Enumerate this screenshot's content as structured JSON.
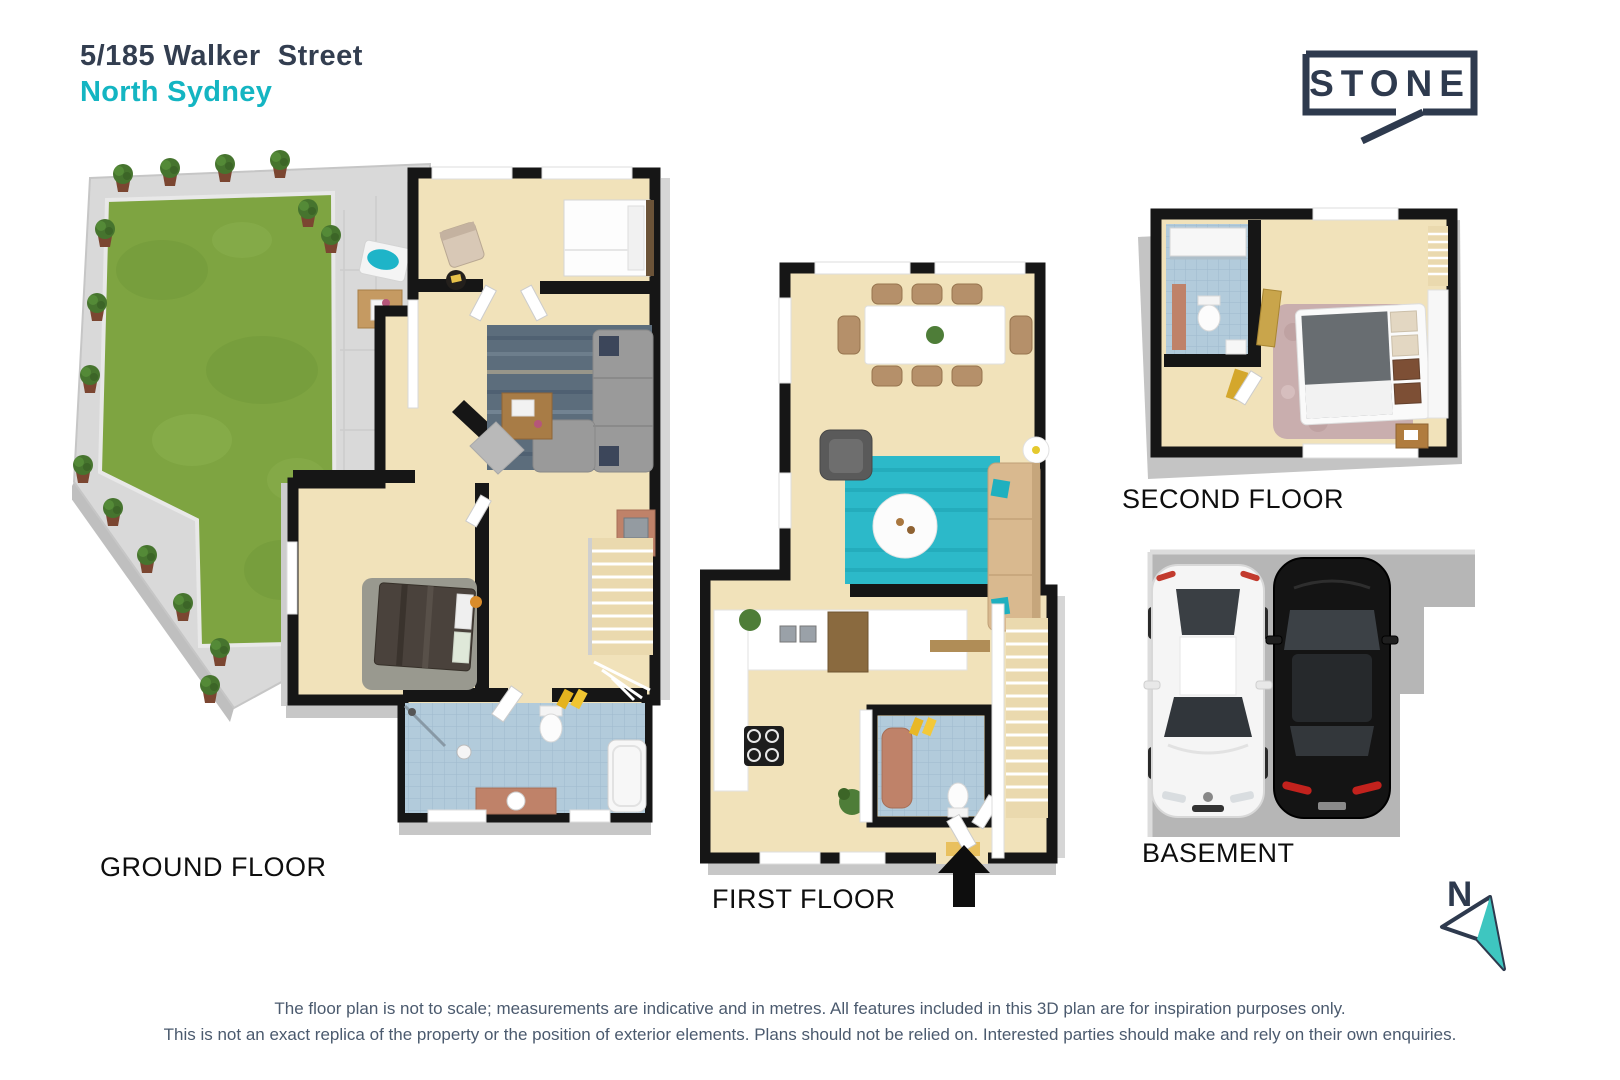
{
  "header": {
    "address_line1": "5/185 Walker  Street",
    "address_line2": "North Sydney",
    "brand": "STONE"
  },
  "floors": {
    "ground": {
      "label": "GROUND FLOOR"
    },
    "first": {
      "label": "FIRST FLOOR"
    },
    "second": {
      "label": "SECOND FLOOR"
    },
    "basement": {
      "label": "BASEMENT"
    }
  },
  "compass": {
    "north_label": "N"
  },
  "disclaimer": {
    "line1": "The floor plan is not to scale; measurements are indicative and in metres. All features included in this 3D plan are for inspiration purposes only.",
    "line2": "This is not an exact replica of the property or the position of exterior elements. Plans should not be relied on. Interested parties should make and rely on their own enquiries."
  },
  "colors": {
    "accent_teal": "#14b5c2",
    "brand_navy": "#2e3a4e",
    "title_navy": "#333e50",
    "label_black": "#0e0e0e",
    "disclaimer_gray": "#4b5a6e",
    "lawn_green": "#7ea441",
    "floor_beige": "#f1e2ba",
    "wall_black": "#161616",
    "paving_gray": "#d9d9d9",
    "bath_tile_blue": "#b2cbdb",
    "rug_teal": "#2cb9c9",
    "rug_mauve": "#c9aeae",
    "sofa_gray": "#9a9a9a",
    "terracotta": "#bf8269"
  }
}
